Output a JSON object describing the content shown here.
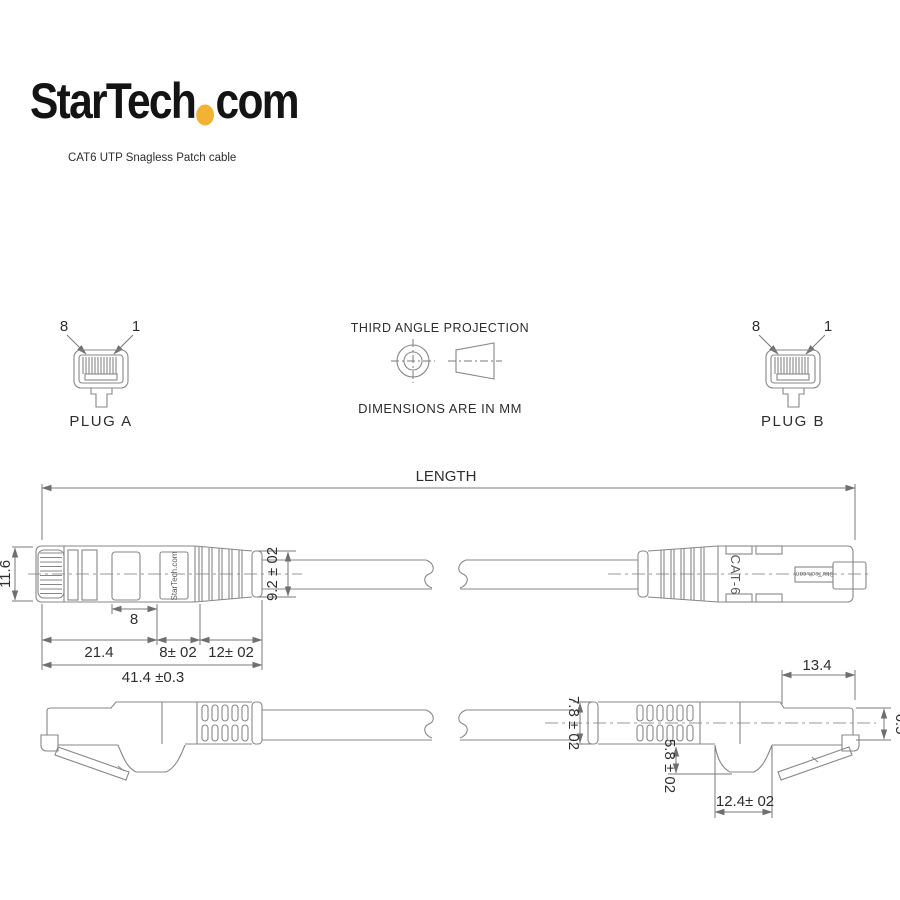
{
  "brand": {
    "logo_text": "StarTech",
    "logo_suffix": "com",
    "tagline": "CAT6 UTP Snagless Patch cable"
  },
  "colors": {
    "accent": "#f2b233"
  },
  "projection": {
    "title": "THIRD ANGLE PROJECTION",
    "note": "DIMENSIONS ARE IN MM"
  },
  "plug_a": {
    "name": "PLUG A",
    "pin_left": "8",
    "pin_right": "1"
  },
  "plug_b": {
    "name": "PLUG B",
    "pin_left": "8",
    "pin_right": "1"
  },
  "top_view": {
    "length_label": "LENGTH",
    "dim_height": "11.6",
    "dim_window": "8",
    "dim_body": "21.4",
    "dim_mid": "8± 02",
    "dim_boot": "12± 02",
    "dim_overall": "41.4 ±0.3",
    "dim_boot_end": "9.2 ± 02",
    "label_brand": "StarTech.com",
    "label_cat": "CAT-6",
    "label_brand_b": "StarTech.com"
  },
  "bottom_view": {
    "dim_boot_od": "7.8 ± 02",
    "dim_hump_depth": "5.8 ± 02",
    "dim_hump_width": "12.4± 02",
    "dim_tip_length": "13.4",
    "dim_tip_height": "6.5"
  }
}
